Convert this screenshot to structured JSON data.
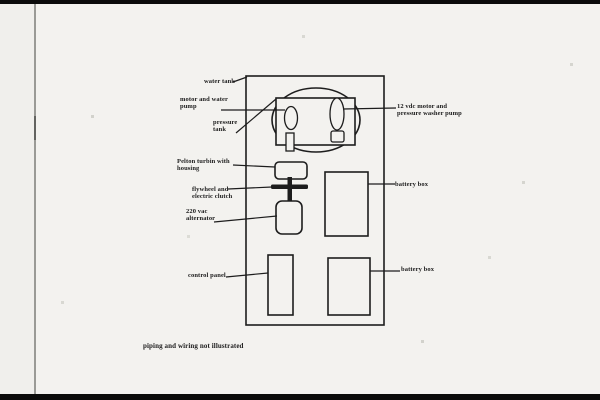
{
  "labels": {
    "water_tank": "water tank",
    "motor_pump": "motor and water\npump",
    "pressure_tank": "pressure\ntank",
    "pelton_turbine": "Pelton turbin with\nhousing",
    "flywheel_clutch": "flywheel and\nelectric clutch",
    "alternator": "220 vac\nalternator",
    "control_panel": "control panel",
    "battery_box_upper": "battery box",
    "battery_box_lower": "battery box",
    "motor_12vdc": "12 vdc motor and\npressure washer pump",
    "note": "piping and wiring not illustrated"
  },
  "colors": {
    "ink": "#1d1d1d",
    "paper": "#f3f2ef",
    "scan_bar": "#0b0b0b",
    "fold_line": "#9a9a96"
  }
}
